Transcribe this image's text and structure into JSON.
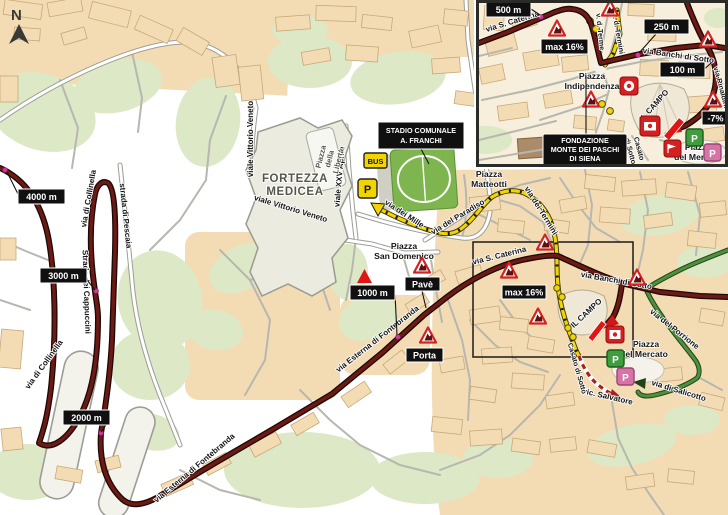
{
  "colors": {
    "route_main": "#6d1a14",
    "route_deviation": "#f2d400",
    "route_parking": "#4f8f3f",
    "building": "#f3dcb4",
    "park": "#dce8c6",
    "marker_bg": "#101010",
    "warning_red": "#d42222",
    "finish_red": "#e01616",
    "parking_green": "#3f9c3f",
    "parking_pink": "#d873a8"
  },
  "compass": {
    "north_label": "N"
  },
  "main_map": {
    "distance_markers": {
      "m4000": "4000 m",
      "m3000": "3000 m",
      "m2000": "2000 m",
      "m1000": "1000 m"
    },
    "hazard_boxes": {
      "pave": "Pavè",
      "porta": "Porta",
      "max_gradient": "max 16%"
    },
    "stadium_label": {
      "line1": "STADIO COMUNALE",
      "line2": "A. FRANCHI"
    },
    "icons": {
      "bus_label": "BUS",
      "parking_label": "P"
    },
    "area_labels": {
      "fortezza": {
        "line1": "FORTEZZA",
        "line2": "MEDICEA"
      },
      "liberta": {
        "line1": "Piazza",
        "line2": "della",
        "line3": "Libertà"
      },
      "san_domenico": {
        "line1": "Piazza",
        "line2": "San Domenico"
      },
      "matteotti": {
        "line1": "Piazza",
        "line2": "Matteotti"
      },
      "campo": "IL CAMPO",
      "mercato": {
        "line1": "Piazza",
        "line2": "del Mercato"
      }
    },
    "street_labels": {
      "vittorio_veneto": "viale Vittorio Veneto",
      "xxv_aprile": "viale XXV Aprile",
      "dei_mille": "via dei Mille",
      "del_paradiso": "via del Paradiso",
      "dei_termini": "via dei Termini",
      "s_caterina": "via S. Caterina",
      "banchi_di_sotto": "via Banchi di Sotto",
      "del_porrione": "via del Porrione",
      "di_salicotto": "via di Salicotto",
      "vic_salvatore": "vic. Salvatore",
      "casato_di_sotto": "Casato di Sotto",
      "esterna_fontebranda": "via Esterna di Fontebranda",
      "di_collinella": "via di Collinella",
      "pescaia": "strada di Pescaia",
      "cappuccini": "Strada dei Cappuccini"
    }
  },
  "inset_map": {
    "distance_markers": {
      "m500": "500 m",
      "m250": "250 m",
      "m100": "100 m"
    },
    "gradient_boxes": {
      "max_gradient": "max 16%",
      "descent": "-7%"
    },
    "foundation_label": {
      "line1": "FONDAZIONE",
      "line2": "MONTE DEI PASCHI",
      "line3": "DI SIENA"
    },
    "area_labels": {
      "indipendenza": {
        "line1": "Piazza",
        "line2": "Indipendenza"
      },
      "campo": "IL CAMPO",
      "mercato": {
        "line1": "Piazza",
        "line2": "del Mercato"
      },
      "casato": {
        "line1": "Casato",
        "line2": "di Sotto"
      }
    },
    "street_labels": {
      "s_caterina": "via S. Caterina",
      "terme": "v. d. Terme",
      "termini": "v. d. Termini",
      "banchi_di_sotto": "via Banchi di Sotto",
      "rinaldini": "via Rinaldini"
    },
    "icons": {
      "parking_label": "P"
    }
  }
}
